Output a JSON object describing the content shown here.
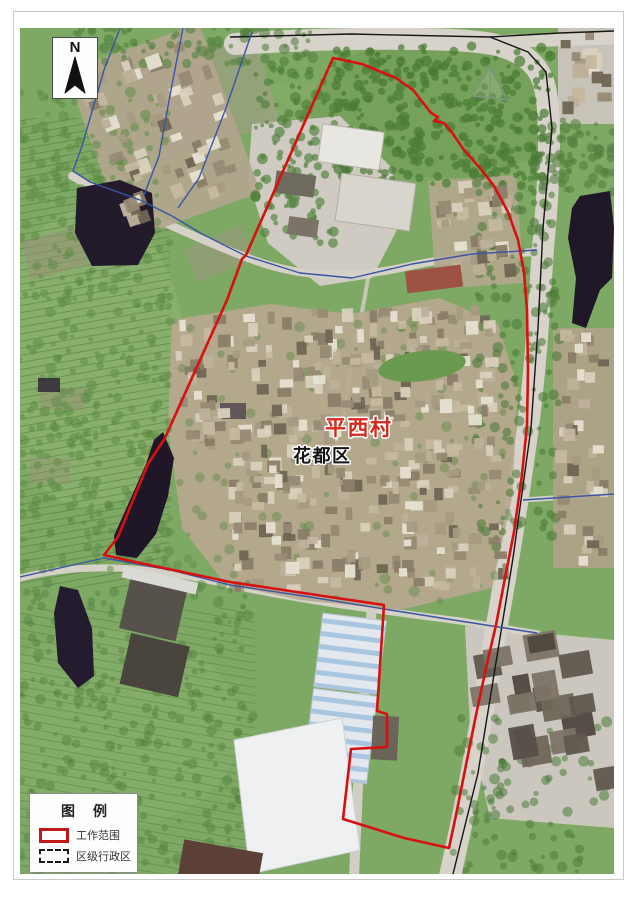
{
  "frame": {
    "background": "#ffffff",
    "border_color": "#c9c9c9"
  },
  "map": {
    "north_arrow": {
      "label": "N"
    },
    "labels": [
      {
        "id": "village-name",
        "text": "平西村",
        "color": "#d6291b",
        "halo": "#ffffff",
        "x": 305,
        "y": 407,
        "size": 21,
        "weight": "bold"
      },
      {
        "id": "district-name",
        "text": "花都区",
        "color": "#141414",
        "halo": "#ffffff",
        "x": 273,
        "y": 434,
        "size": 18,
        "weight": "bold"
      }
    ],
    "legend": {
      "title": "图　例",
      "items": [
        {
          "label": "工作范围",
          "type": "work-scope",
          "color": "#c01818",
          "style": "solid-red-rectangle"
        },
        {
          "label": "区级行政区",
          "type": "district",
          "color": "#1c1c1c",
          "style": "black-dashed-rectangle"
        }
      ]
    },
    "boundaries": {
      "work_scope": {
        "color": "#d81010",
        "width": 2.6,
        "points": [
          [
            313,
            30
          ],
          [
            342,
            36
          ],
          [
            376,
            50
          ],
          [
            393,
            62
          ],
          [
            404,
            76
          ],
          [
            411,
            85
          ],
          [
            418,
            89
          ],
          [
            414,
            93
          ],
          [
            424,
            95
          ],
          [
            433,
            106
          ],
          [
            444,
            122
          ],
          [
            460,
            140
          ],
          [
            474,
            158
          ],
          [
            488,
            184
          ],
          [
            498,
            212
          ],
          [
            504,
            244
          ],
          [
            507,
            282
          ],
          [
            508,
            342
          ],
          [
            507,
            397
          ],
          [
            502,
            447
          ],
          [
            494,
            504
          ],
          [
            485,
            550
          ],
          [
            476,
            597
          ],
          [
            466,
            640
          ],
          [
            456,
            687
          ],
          [
            446,
            737
          ],
          [
            436,
            787
          ],
          [
            429,
            820
          ],
          [
            384,
            810
          ],
          [
            323,
            791
          ],
          [
            331,
            721
          ],
          [
            367,
            719
          ],
          [
            367,
            686
          ],
          [
            357,
            683
          ],
          [
            364,
            577
          ],
          [
            290,
            566
          ],
          [
            210,
            554
          ],
          [
            120,
            535
          ],
          [
            84,
            527
          ],
          [
            98,
            509
          ],
          [
            111,
            477
          ],
          [
            128,
            436
          ],
          [
            145,
            410
          ],
          [
            207,
            272
          ],
          [
            222,
            231
          ],
          [
            226,
            227
          ]
        ]
      },
      "district_lines": {
        "color": "#3a55a4",
        "width": 1.4,
        "polylines": [
          [
            [
              100,
              0
            ],
            [
              84,
              42
            ],
            [
              62,
              118
            ],
            [
              53,
              143
            ],
            [
              70,
              154
            ],
            [
              120,
              172
            ],
            [
              152,
              188
            ],
            [
              182,
              206
            ],
            [
              226,
              228
            ]
          ],
          [
            [
              163,
              0
            ],
            [
              151,
              62
            ],
            [
              139,
              128
            ],
            [
              124,
              167
            ]
          ],
          [
            [
              232,
              4
            ],
            [
              206,
              80
            ],
            [
              179,
              150
            ],
            [
              158,
              180
            ]
          ],
          [
            [
              226,
              228
            ],
            [
              280,
              245
            ],
            [
              332,
              250
            ],
            [
              392,
              236
            ],
            [
              452,
              226
            ],
            [
              517,
              222
            ]
          ],
          [
            [
              0,
              549
            ],
            [
              84,
              530
            ],
            [
              150,
              542
            ],
            [
              210,
              557
            ],
            [
              290,
              569
            ],
            [
              364,
              581
            ],
            [
              440,
              593
            ],
            [
              517,
              605
            ]
          ],
          [
            [
              503,
              472
            ],
            [
              594,
              466
            ]
          ]
        ]
      },
      "road_casings": {
        "color": "#161616",
        "width": 1.4,
        "polylines": [
          [
            [
              210,
              9
            ],
            [
              330,
              6
            ],
            [
              470,
              9
            ],
            [
              508,
              24
            ],
            [
              526,
              44
            ],
            [
              532,
              100
            ],
            [
              523,
              200
            ],
            [
              518,
              300
            ],
            [
              511,
              400
            ],
            [
              493,
              530
            ],
            [
              478,
              622
            ],
            [
              458,
              745
            ],
            [
              433,
              846
            ]
          ],
          [
            [
              470,
              9
            ],
            [
              540,
              5
            ],
            [
              594,
              3
            ]
          ]
        ]
      }
    }
  }
}
